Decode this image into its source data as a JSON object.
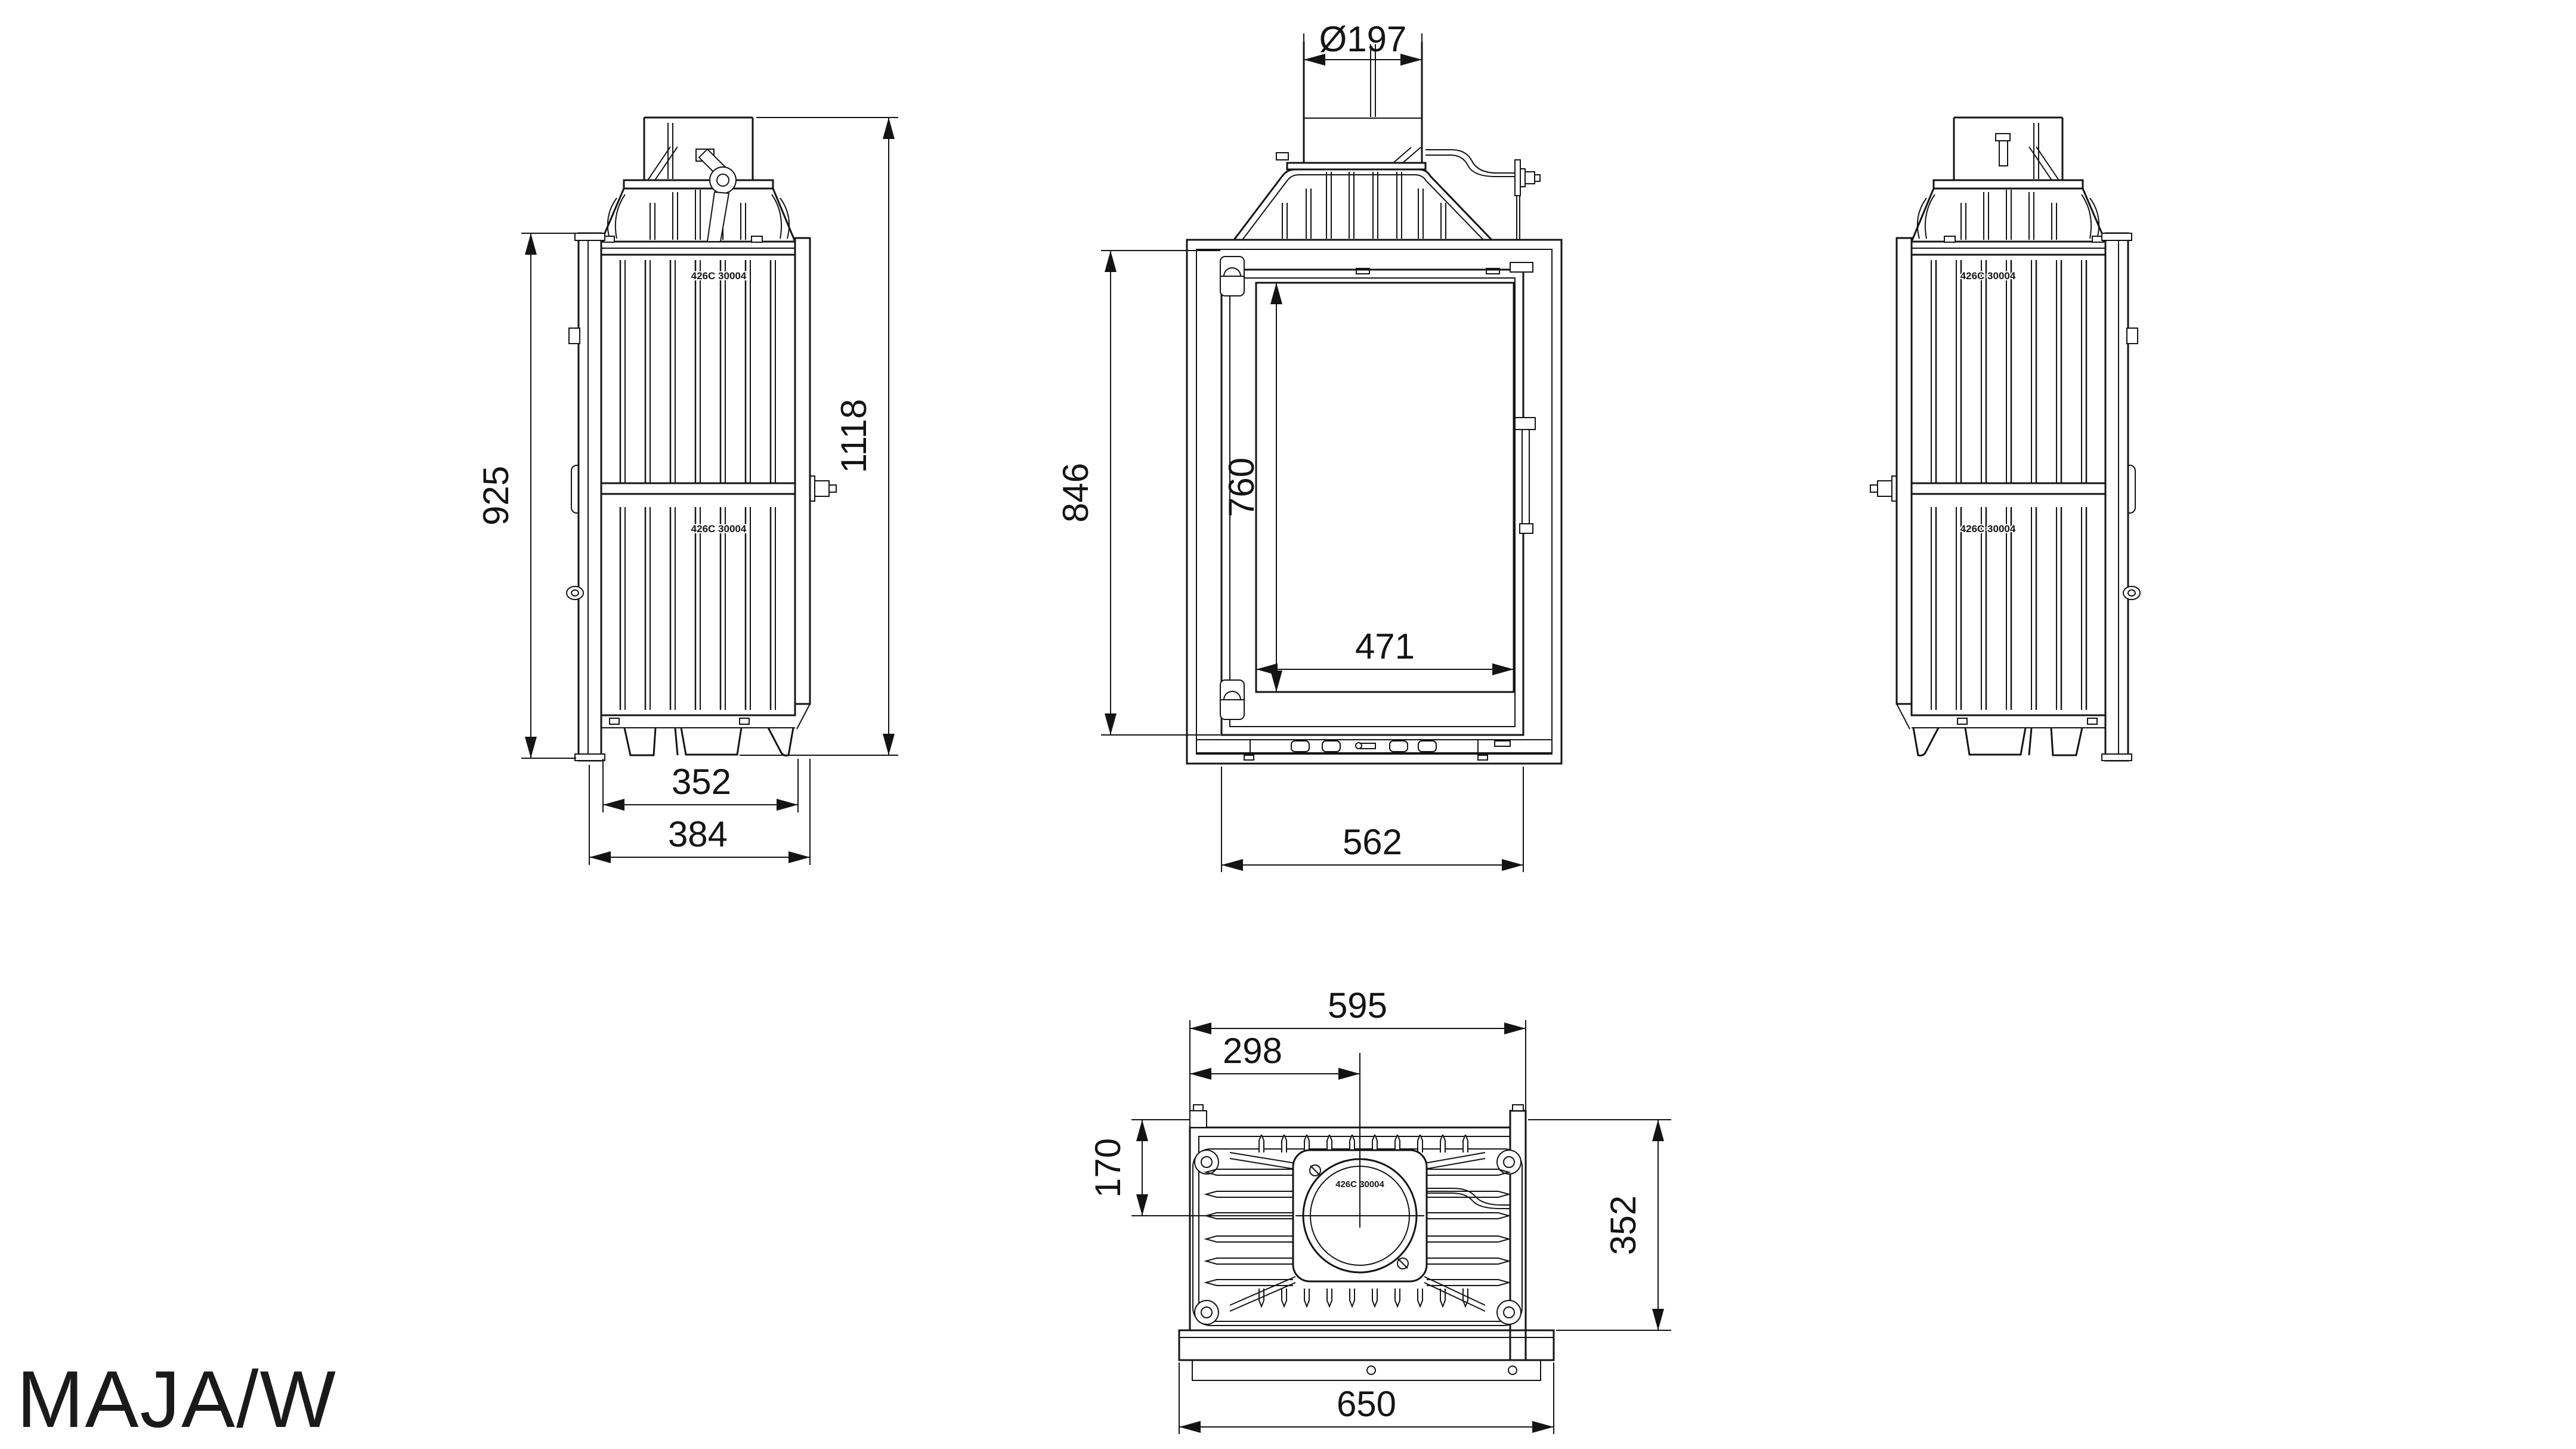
{
  "title": "MAJA/W",
  "colors": {
    "ink": "#141414",
    "background": "#ffffff"
  },
  "views": {
    "side_left": {
      "cast_mark": "426C 30004",
      "dims": {
        "body_height": "925",
        "total_height": "1118",
        "body_depth": "352",
        "total_depth": "384"
      }
    },
    "front": {
      "dims": {
        "flue_diameter": "Ø197",
        "opening_height": "846",
        "glass_height": "760",
        "glass_width": "471",
        "opening_width": "562"
      }
    },
    "side_right": {
      "cast_mark": "426C 30004"
    },
    "top": {
      "cast_mark": "426C 30004",
      "dims": {
        "mounting_width": "595",
        "flue_offset_x": "298",
        "flue_offset_y": "170",
        "body_depth": "352",
        "base_width": "650"
      }
    }
  }
}
